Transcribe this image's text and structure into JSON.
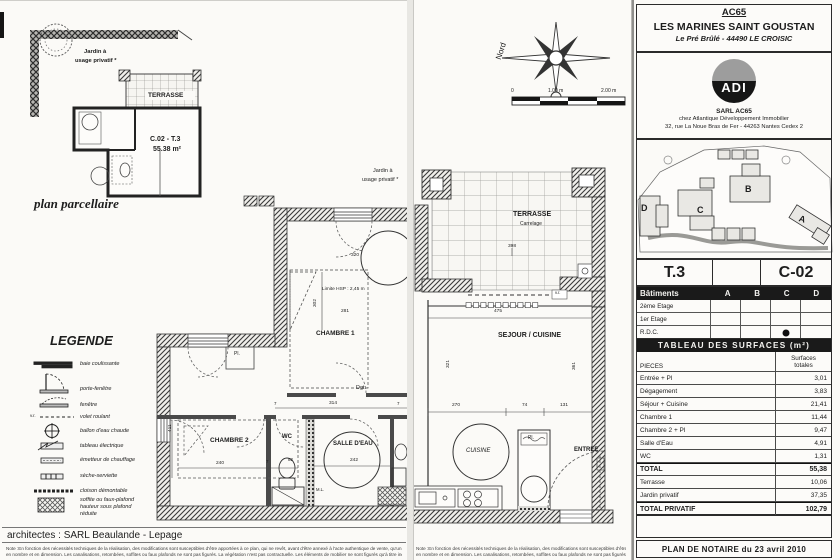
{
  "header": {
    "code": "AC65",
    "name": "LES MARINES SAINT GOUSTAN",
    "address": "Le Pré Brûlé - 44490 LE CROISIC"
  },
  "agency": {
    "logo": "ADI",
    "name": "SARL AC65",
    "line2": "chez Atlantique Développement Immobilier",
    "line3": "32, rue La Noue Bras de Fer - 44263 Nantes Cedex 2"
  },
  "site": {
    "a": "A",
    "b": "B",
    "c": "C",
    "d": "D"
  },
  "unit": {
    "type": "T.3",
    "number": "C-02"
  },
  "batiments": {
    "title": "Bâtiments",
    "cols": [
      "A",
      "B",
      "C",
      "D"
    ],
    "rows": [
      "2ème Etage",
      "1er Etage",
      "R.D.C."
    ]
  },
  "surfaces": {
    "title": "TABLEAU DES SURFACES (m²)",
    "col_pieces": "PIECES",
    "col_totals_1": "Surfaces",
    "col_totals_2": "totales",
    "rows": [
      {
        "label": "Entrée + Pl",
        "value": "3,01"
      },
      {
        "label": "Dégagement",
        "value": "3,83"
      },
      {
        "label": "Séjour + Cuisine",
        "value": "21,41"
      },
      {
        "label": "Chambre 1",
        "value": "11,44"
      },
      {
        "label": "Chambre 2 + Pl",
        "value": "9,47"
      },
      {
        "label": "Salle d'Eau",
        "value": "4,91"
      },
      {
        "label": "WC",
        "value": "1,31"
      },
      {
        "label": "TOTAL",
        "value": "55,38"
      },
      {
        "label": "Terrasse",
        "value": "10,06"
      },
      {
        "label": "Jardin privatif",
        "value": "37,35"
      },
      {
        "label": "TOTAL PRIVATIF",
        "value": "102,79"
      }
    ]
  },
  "notaire": "PLAN DE NOTAIRE du 23 avril 2010",
  "parcel": {
    "caption": "plan parcellaire",
    "garden1": "Jardin à",
    "garden2": "usage privatif *",
    "terrace": "TERRASSE",
    "unit_label": "C.02 - T.3",
    "unit_area": "55.38 m²"
  },
  "legend": {
    "title": "LEGENDE",
    "vr": "v.r.",
    "items": [
      "baie coulissante",
      "porte-fenêtre",
      "fenêtre",
      "volet roulant",
      "ballon d'eau chaude",
      "tableau électrique",
      "émetteur de chauffage",
      "sèche-serviette",
      "cloison démontable",
      "soffite ou faux-plafond"
    ],
    "item10b": "hauteur sous plafond",
    "item10c": "réduite"
  },
  "plan_left": {
    "garden1": "Jardin à",
    "garden2": "usage privatif *",
    "chambre1": "CHAMBRE 1",
    "chambre2": "CHAMBRE 2",
    "wc": "WC",
    "salle_eau": "SALLE D'EAU",
    "dgt": "Dgt.",
    "pl": "Pl.",
    "ml": "M.L.",
    "hsp": "Limite HSP : 2,45 m",
    "d320": "320",
    "d302": "302",
    "d281": "281",
    "d411": "411",
    "d240": "240",
    "d7a": "7",
    "d314": "314",
    "d7b": "7",
    "d7c": "7",
    "d82": "82",
    "d242": "242"
  },
  "plan_mid": {
    "nord": "Nord",
    "s0": "0",
    "s1": "1.00 m",
    "s2": "2.00 m",
    "terrace": "TERRASSE",
    "carrelage": "Carrelage",
    "d398": "398",
    "vr": "v.r.",
    "sejour": "SEJOUR / CUISINE",
    "d475": "475",
    "d321": "321",
    "d361": "361",
    "d270": "270",
    "d74": "74",
    "d131": "131",
    "cuisine": "CUISINE",
    "pl": "Pl.",
    "entree": "ENTREE"
  },
  "credits": {
    "architects": "architectes : SARL Beaulande - Lepage",
    "note1": "Note :En fonction des nécessités techniques de la réalisation, des modifications sont susceptibles d'être apportées à ce plan, qui ne revêt, avant d'être annexé à l'acte authentique de vente, qu'un caractère informatif. La",
    "note2": "en nombre et en dimension. Les canalisations, retombées, soffites ou faux plafonds ne sont pas figurés. La végétation n'est pas contractuelle. Les éléments de mobilier ne sont figurés qu'à titre indicatif."
  }
}
